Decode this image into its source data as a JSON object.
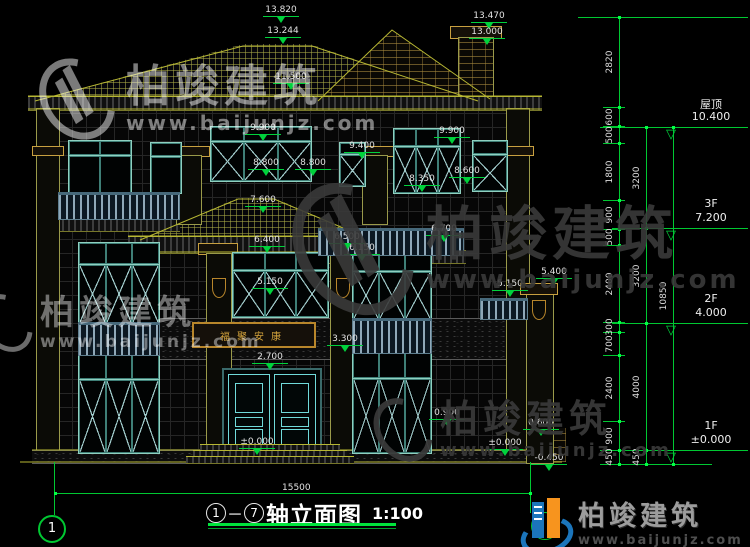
{
  "drawing": {
    "title": {
      "axis_start": "1",
      "axis_end": "7",
      "separator": "－",
      "name": "轴立面图",
      "scale": "1:100"
    },
    "bottom_dim": {
      "value": "15500"
    },
    "axis_bubble_left": "1",
    "plaque": {
      "text": "福聚安康"
    },
    "annotations": [
      {
        "v": "13.820",
        "x": 281,
        "y": 5
      },
      {
        "v": "13.244",
        "x": 283,
        "y": 26
      },
      {
        "v": "13.470",
        "x": 489,
        "y": 11
      },
      {
        "v": "13.000",
        "x": 487,
        "y": 27
      },
      {
        "v": "11.500",
        "x": 291,
        "y": 72
      },
      {
        "v": "9.900",
        "x": 263,
        "y": 123
      },
      {
        "v": "9.900",
        "x": 452,
        "y": 126
      },
      {
        "v": "9.400",
        "x": 362,
        "y": 141
      },
      {
        "v": "8.800",
        "x": 266,
        "y": 158
      },
      {
        "v": "8.800",
        "x": 313,
        "y": 158
      },
      {
        "v": "8.600",
        "x": 467,
        "y": 166
      },
      {
        "v": "8.350",
        "x": 422,
        "y": 174
      },
      {
        "v": "7.600",
        "x": 263,
        "y": 195
      },
      {
        "v": "6.700",
        "x": 444,
        "y": 224
      },
      {
        "v": "6.400",
        "x": 267,
        "y": 235
      },
      {
        "v": "6.500",
        "x": 347,
        "y": 232
      },
      {
        "v": "6.150",
        "x": 362,
        "y": 243
      },
      {
        "v": "5.400",
        "x": 554,
        "y": 267
      },
      {
        "v": "5.150",
        "x": 270,
        "y": 277
      },
      {
        "v": "5.150",
        "x": 510,
        "y": 279
      },
      {
        "v": "3.300",
        "x": 345,
        "y": 334
      },
      {
        "v": "2.700",
        "x": 270,
        "y": 352
      },
      {
        "v": "0.900",
        "x": 447,
        "y": 408
      },
      {
        "v": "0.600",
        "x": 541,
        "y": 418
      },
      {
        "v": "±0.000",
        "x": 505,
        "y": 438
      },
      {
        "v": "±0.000",
        "x": 257,
        "y": 437
      },
      {
        "v": "-0.450",
        "x": 549,
        "y": 453
      }
    ],
    "floor_markers": [
      {
        "label": "屋顶",
        "value": "10.400",
        "ly": 127
      },
      {
        "label": "3F",
        "value": "7.200",
        "ly": 228
      },
      {
        "label": "2F",
        "value": "4.000",
        "ly": 323
      },
      {
        "label": "1F",
        "value": "±0.000",
        "ly": 450
      }
    ],
    "dim_chains": [
      {
        "x": 619,
        "ticks": [
          17,
          107,
          126,
          143,
          200,
          229,
          245,
          322,
          332,
          355,
          421,
          450,
          464
        ],
        "labels": [
          "2820",
          "600",
          "500",
          "1800",
          "900",
          "500",
          "2400",
          "300",
          "700",
          "2400",
          "900",
          "450"
        ]
      },
      {
        "x": 646,
        "ticks": [
          127,
          228,
          323,
          450,
          464
        ],
        "labels": [
          "3200",
          "3200",
          "4000",
          "450"
        ]
      },
      {
        "x": 673,
        "ticks": [
          127,
          464
        ],
        "labels": [
          "10850"
        ]
      }
    ],
    "colors": {
      "dim_green": "#00d23c",
      "line_olive": "#b7b733",
      "teal_frame": "#8fd0c0",
      "logo_blue": "#1b75bb",
      "logo_orange": "#f7941e"
    }
  },
  "watermark": {
    "brand": "柏竣建筑",
    "site": "www.baijunjz.com"
  }
}
